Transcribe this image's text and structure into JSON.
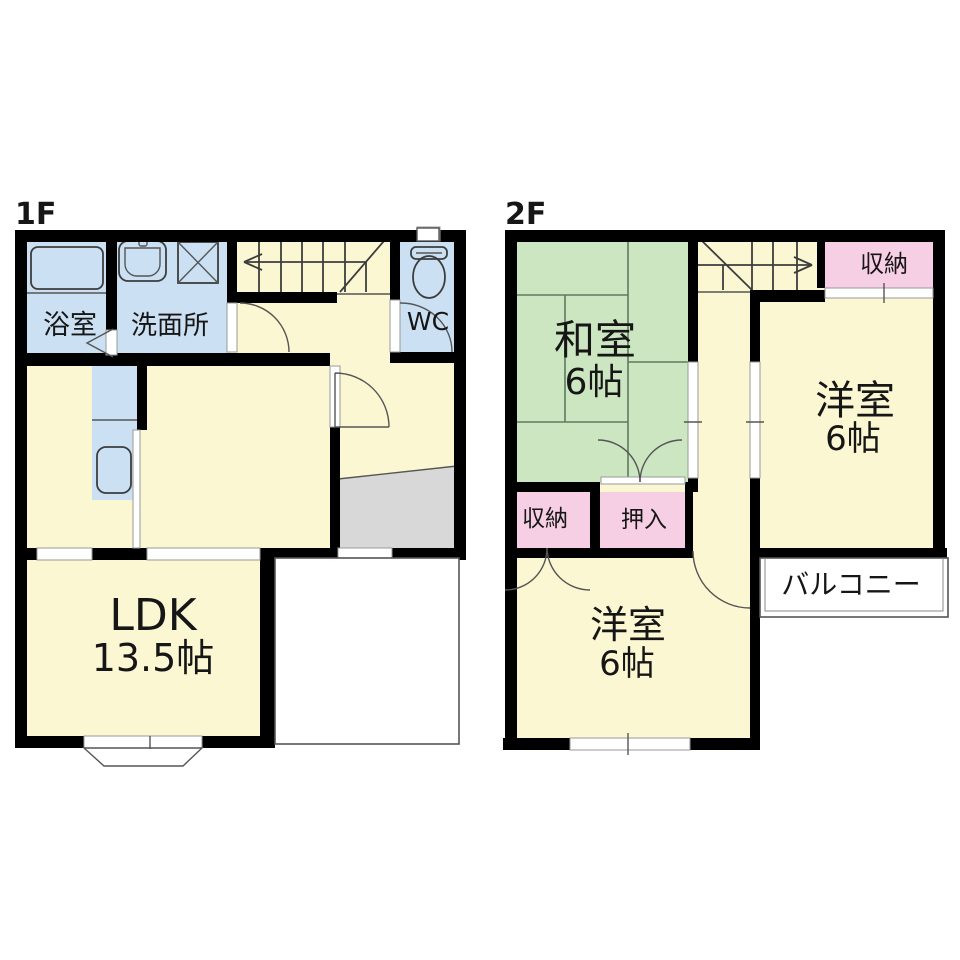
{
  "floor1": {
    "label": "1F",
    "bath": "浴室",
    "washroom": "洗面所",
    "wc": "WC",
    "ldk_name": "LDK",
    "ldk_size": "13.5帖"
  },
  "floor2": {
    "label": "2F",
    "washitsu_name": "和室",
    "washitsu_size": "6帖",
    "yoshitsu_east_name": "洋室",
    "yoshitsu_east_size": "6帖",
    "yoshitsu_south_name": "洋室",
    "yoshitsu_south_size": "6帖",
    "closet_north": "収納",
    "closet_west": "収納",
    "oshiire": "押入",
    "balcony": "バルコニー"
  },
  "colors": {
    "room_yellow": "#FBF7D3",
    "tatami_green": "#CBE6C1",
    "wet_blue": "#CBE0F2",
    "closet_pink": "#F7CFE5",
    "genkan_gray": "#D8D8D8",
    "wall_black": "#000000"
  }
}
